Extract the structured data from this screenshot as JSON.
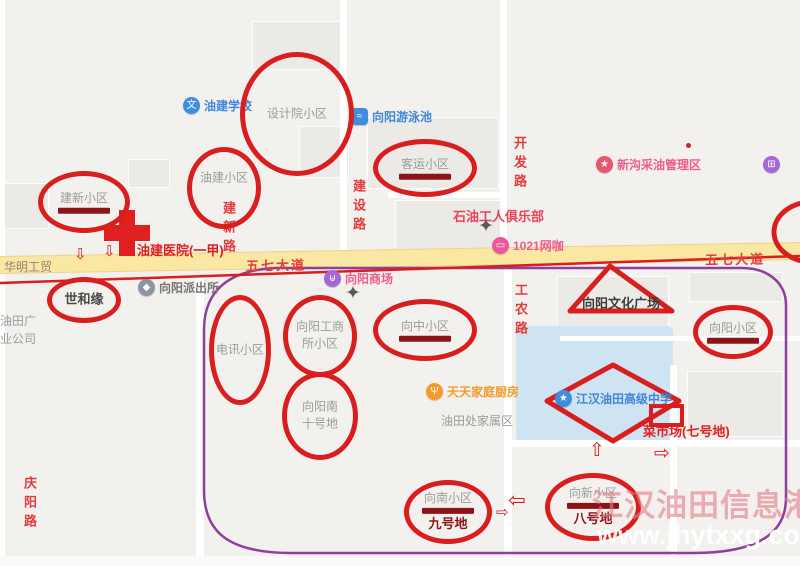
{
  "page": {
    "width": 800,
    "height": 566
  },
  "colors": {
    "map_background": "#f2f1ee",
    "building_block": "#eceae6",
    "road_white": "#ffffff",
    "main_road_yellow": "#f9e7a2",
    "pond_blue": "#cfe4f2",
    "road_label_red": "#e23c3c",
    "annotation_red": "#d81e1e",
    "underline_dark_red": "#8c1418",
    "boundary_purple": "#8e3f9e",
    "poi_blue": "#3f86d8",
    "poi_pink": "#ee5b8c",
    "poi_purple": "#a668d8",
    "poi_orange": "#f39b2d",
    "hospital_red": "#e01f1f",
    "label_gray": "#9b9b9b"
  },
  "map": {
    "road_labels": [
      {
        "text": "五七大道",
        "x": 246,
        "y": 255,
        "vertical": false,
        "tilt": true
      },
      {
        "text": "五七大道",
        "x": 705,
        "y": 249,
        "vertical": false,
        "tilt": true
      },
      {
        "text": "建设路",
        "x": 349,
        "y": 179,
        "vertical": true
      },
      {
        "text": "开发路",
        "x": 510,
        "y": 136,
        "vertical": true
      },
      {
        "text": "建新路",
        "x": 219,
        "y": 201,
        "vertical": true
      },
      {
        "text": "工农路",
        "x": 511,
        "y": 283,
        "vertical": true
      },
      {
        "text": "庆阳路",
        "x": 20,
        "y": 476,
        "vertical": true
      }
    ],
    "area_labels": [
      {
        "text": "华明工贸",
        "x": 4,
        "y": 258,
        "color": "roadgray"
      },
      {
        "text": "油田广\n业公司",
        "x": 0,
        "y": 312,
        "color": "gray"
      },
      {
        "text": "油田处家属区",
        "x": 441,
        "y": 412,
        "color": "gray"
      }
    ],
    "pois": [
      {
        "label": "油建学校",
        "x": 183,
        "y": 97,
        "icon": "school-icon",
        "shape": "circle",
        "bg": "#3d8edd",
        "glyph": "文",
        "color": "blue"
      },
      {
        "label": "向阳游泳池",
        "x": 351,
        "y": 108,
        "icon": "swimming-pool-icon",
        "shape": "square",
        "bg": "#3d8edd",
        "glyph": "≈",
        "color": "blue"
      },
      {
        "label": "新沟采油管理区",
        "x": 596,
        "y": 156,
        "icon": "star-badge-icon",
        "shape": "circle",
        "bg": "#e8566d",
        "glyph": "★",
        "color": "pink"
      },
      {
        "label": "",
        "x": 763,
        "y": 156,
        "icon": "shopping-cart-icon",
        "shape": "circle",
        "bg": "#a668d8",
        "glyph": "⊞",
        "color": "pink"
      },
      {
        "label": "向阳商场",
        "x": 324,
        "y": 270,
        "icon": "shopping-bag-icon",
        "shape": "circle",
        "bg": "#a668d8",
        "glyph": "⊎",
        "color": "pink"
      },
      {
        "label": "1021网咖",
        "x": 492,
        "y": 237,
        "icon": "chat-bubble-icon",
        "shape": "circle",
        "bg": "#ee579e",
        "glyph": "▭",
        "color": "pink"
      },
      {
        "label": "向阳派出所",
        "x": 138,
        "y": 279,
        "icon": "police-badge-icon",
        "shape": "circle",
        "bg": "#8b95a1",
        "glyph": "◆",
        "color": "midgray"
      },
      {
        "label": "天天家庭厨房",
        "x": 426,
        "y": 383,
        "icon": "restaurant-icon",
        "shape": "circle",
        "bg": "#f39b2d",
        "glyph": "Ψ",
        "color": "orange"
      },
      {
        "label": "江汉油田高级中学",
        "x": 555,
        "y": 390,
        "icon": "school-icon",
        "shape": "circle",
        "bg": "#3d8edd",
        "glyph": "★",
        "color": "blue"
      }
    ],
    "text_pois": [
      {
        "label": "石油工人俱乐部",
        "x": 453,
        "y": 206,
        "color": "redpink",
        "bold": true
      },
      {
        "label": "油建医院(一甲)",
        "x": 137,
        "y": 240,
        "color": "red",
        "bold": true
      },
      {
        "label": "菜市场(七号地)",
        "x": 643,
        "y": 421,
        "color": "red",
        "bold": true
      }
    ],
    "deco_icons": [
      {
        "icon": "crossroad-star-icon",
        "x": 345,
        "y": 284
      },
      {
        "icon": "crossroad-star-icon",
        "x": 478,
        "y": 217
      }
    ],
    "annotations": {
      "circles": [
        {
          "label": "设计院小区",
          "cx": 297,
          "cy": 114,
          "rx": 57,
          "ry": 62
        },
        {
          "label": "油建小区",
          "cx": 224,
          "cy": 188,
          "rx": 37,
          "ry": 41,
          "label_dy": -10
        },
        {
          "label": "客运小区",
          "cx": 425,
          "cy": 168,
          "rx": 52,
          "ry": 29,
          "underline": true
        },
        {
          "label": "建新小区",
          "cx": 84,
          "cy": 202,
          "rx": 46,
          "ry": 31,
          "underline": true
        },
        {
          "label": "世和缘",
          "cx": 84,
          "cy": 300,
          "rx": 37,
          "ry": 23,
          "dark": true
        },
        {
          "label": "电讯小区",
          "cx": 240,
          "cy": 350,
          "rx": 31,
          "ry": 55
        },
        {
          "label": "向阳工商\n所小区",
          "cx": 320,
          "cy": 336,
          "rx": 37,
          "ry": 41
        },
        {
          "label": "向中小区",
          "cx": 425,
          "cy": 330,
          "rx": 52,
          "ry": 31,
          "underline": true
        },
        {
          "label": "向阳小区",
          "cx": 733,
          "cy": 332,
          "rx": 40,
          "ry": 27,
          "underline": true
        },
        {
          "label": "向阳南\n十号地",
          "cx": 320,
          "cy": 416,
          "rx": 38,
          "ry": 44
        },
        {
          "label": "向南小区",
          "sublabel": "九号地",
          "cx": 448,
          "cy": 512,
          "rx": 44,
          "ry": 32,
          "underline": true
        },
        {
          "label": "向新小区",
          "sublabel": "八号地",
          "cx": 593,
          "cy": 507,
          "rx": 48,
          "ry": 34,
          "underline": true
        }
      ],
      "triangle": {
        "label": "向阳文化广场",
        "label_x": 582,
        "label_y": 293
      },
      "diamond": {
        "label": "江汉油田高级中学"
      },
      "market_rect": {
        "label": "菜市场(七号地)"
      },
      "arrows": [
        {
          "dir": "down",
          "x": 74,
          "y": 247,
          "size": 15
        },
        {
          "dir": "down",
          "x": 103,
          "y": 244,
          "size": 15
        },
        {
          "dir": "up",
          "x": 589,
          "y": 441,
          "size": 19
        },
        {
          "dir": "right",
          "x": 654,
          "y": 444,
          "size": 19
        },
        {
          "dir": "left",
          "x": 508,
          "y": 490,
          "size": 21
        },
        {
          "dir": "right",
          "x": 496,
          "y": 505,
          "size": 15
        }
      ]
    },
    "watermark": {
      "title": "江汉油田信息港",
      "url": "www.jhytxxg.com"
    }
  }
}
